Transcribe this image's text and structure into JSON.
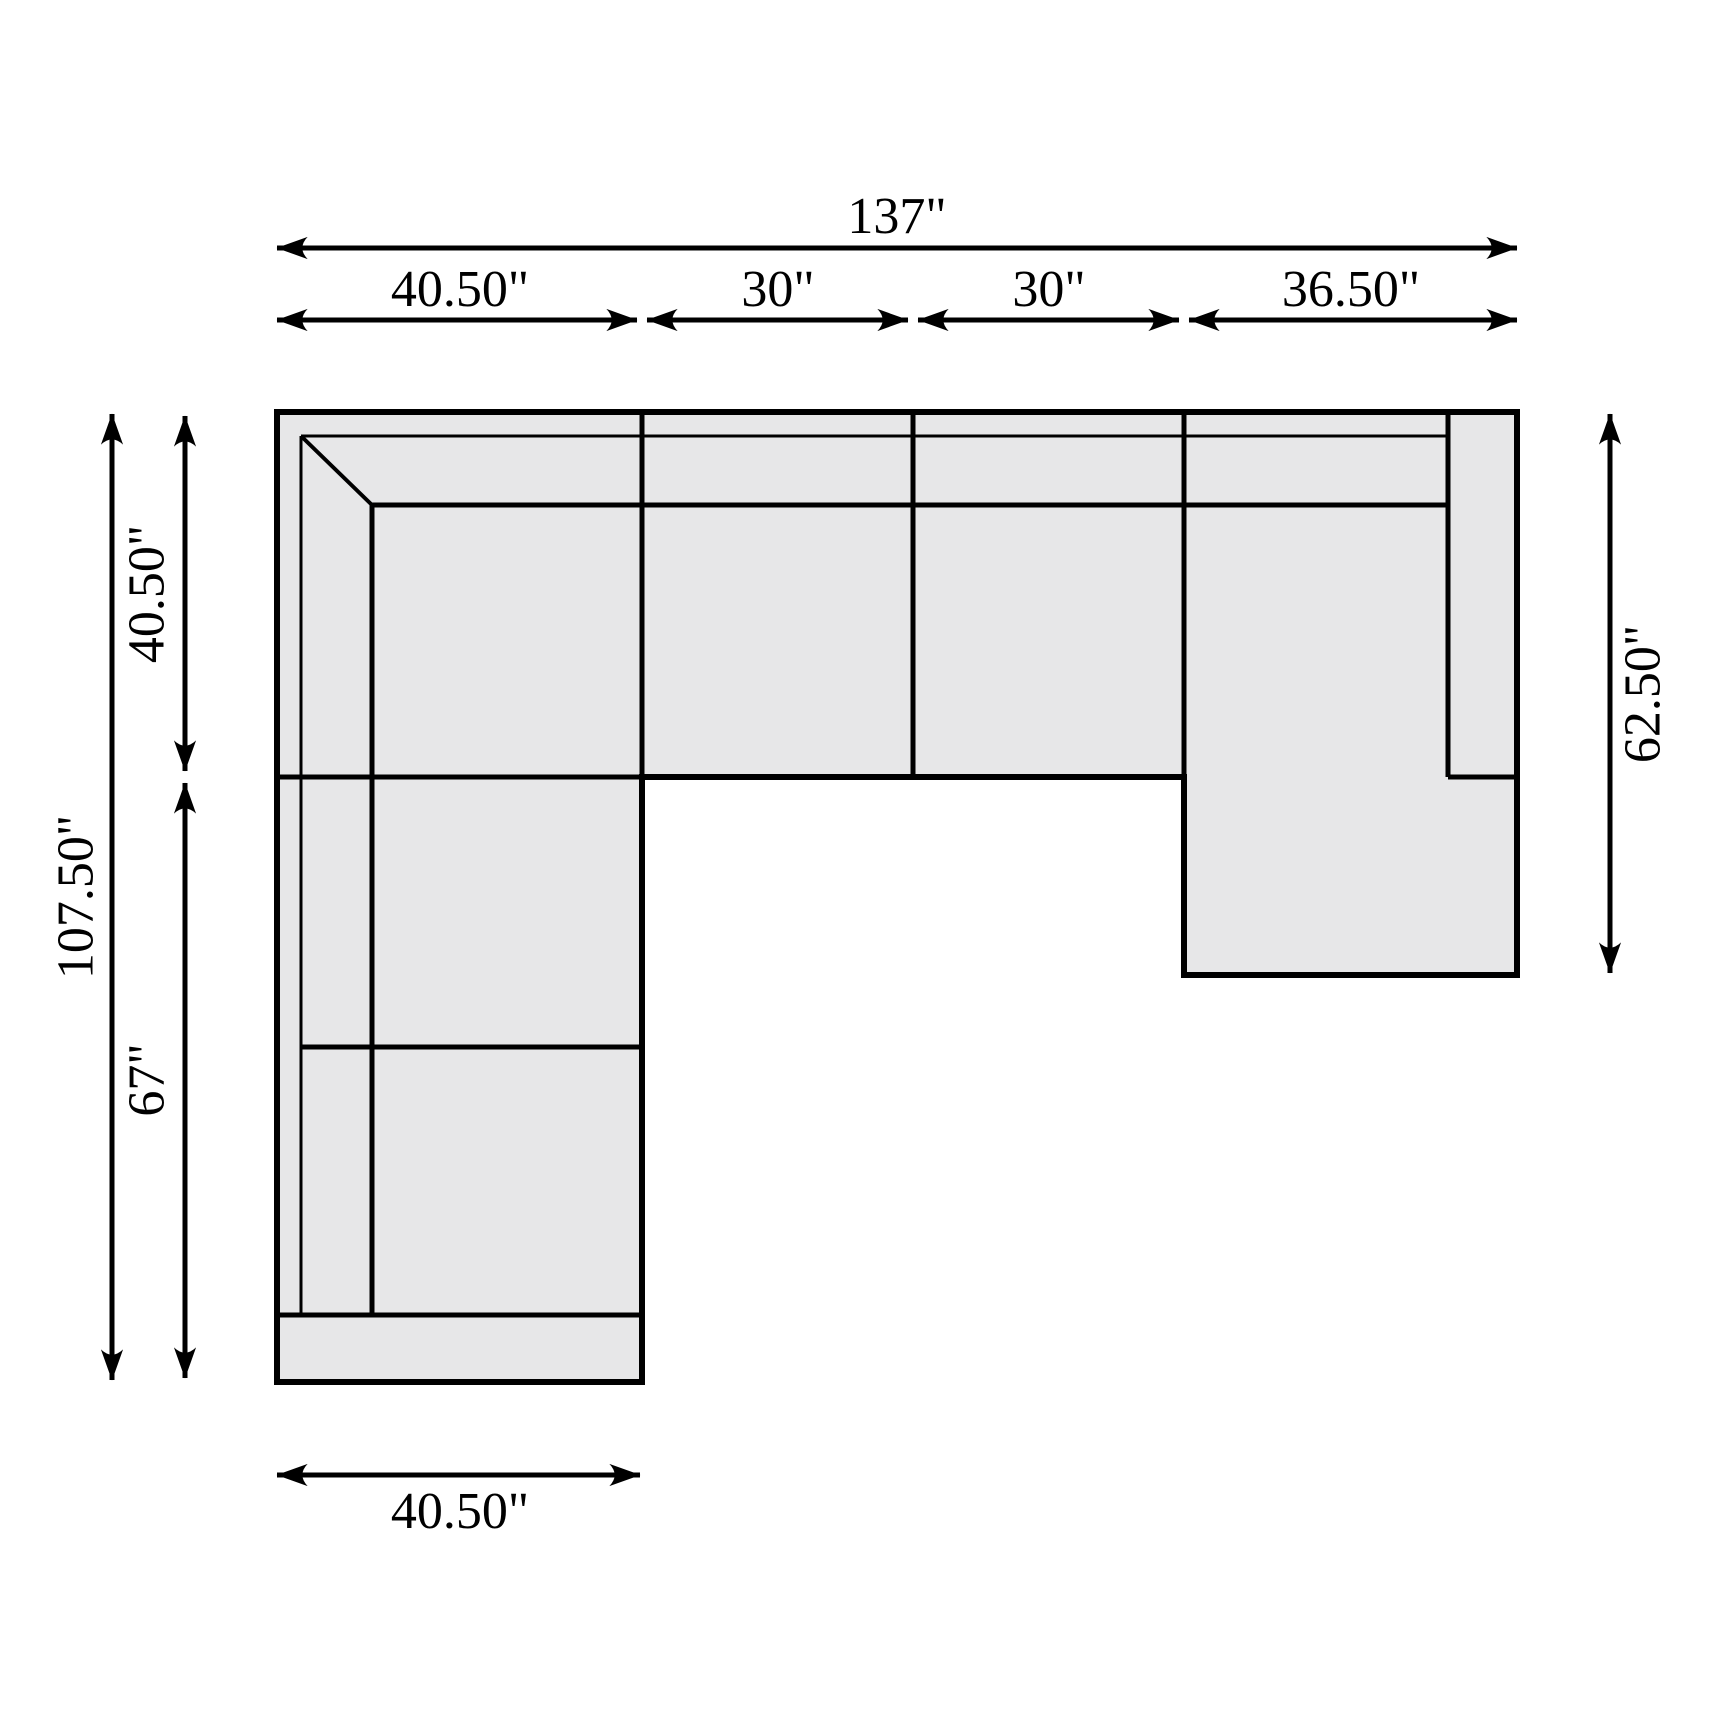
{
  "diagram": {
    "title": "Sectional sofa dimension drawing (top view)",
    "units": "inches",
    "colors": {
      "background": "#ffffff",
      "sofa_fill": "#e7e7e8",
      "line_color": "#000000"
    },
    "dimensions": {
      "overall_width": {
        "label": "137\"",
        "value": 137
      },
      "top_segments": [
        {
          "label": "40.50\"",
          "value": 40.5
        },
        {
          "label": "30\"",
          "value": 30
        },
        {
          "label": "30\"",
          "value": 30
        },
        {
          "label": "36.50\"",
          "value": 36.5
        }
      ],
      "overall_depth_left": {
        "label": "107.50\"",
        "value": 107.5
      },
      "left_segments": [
        {
          "label": "40.50\"",
          "value": 40.5
        },
        {
          "label": "67\"",
          "value": 67
        }
      ],
      "chaise_depth_right": {
        "label": "62.50\"",
        "value": 62.5
      },
      "bottom_width": {
        "label": "40.50\"",
        "value": 40.5
      }
    }
  }
}
